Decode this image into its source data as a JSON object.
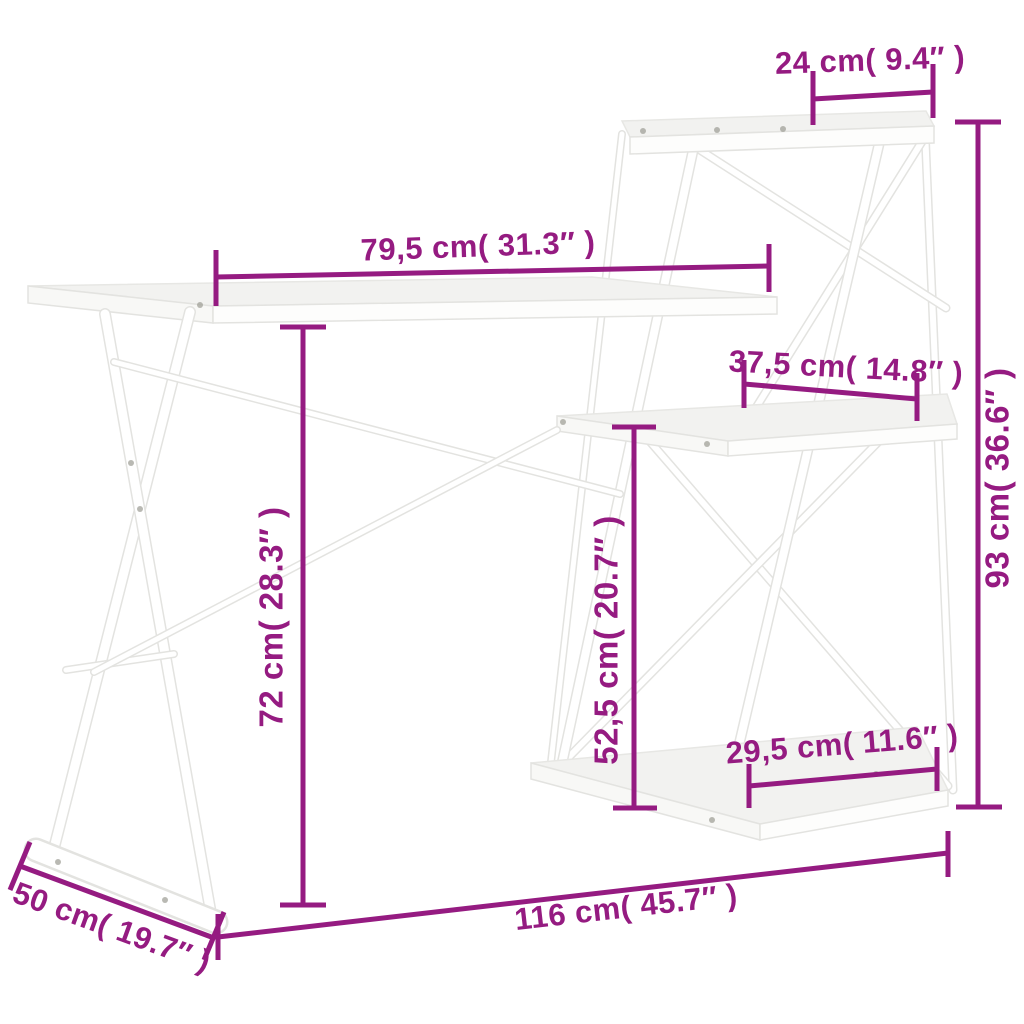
{
  "image_type": "product-dimension-diagram",
  "product": {
    "name": "desk with shelves",
    "furniture_color": "white"
  },
  "colors": {
    "accent": "#951b81",
    "background": "#ffffff",
    "furniture": "#ffffff",
    "outline": "#e3e3e0"
  },
  "dims": {
    "top_shelf_depth": {
      "label": "24 cm( 9.4″ )"
    },
    "desktop_length": {
      "label": "79,5 cm( 31.3″ )"
    },
    "middle_shelf_depth": {
      "label": "37,5 cm( 14.8″ )"
    },
    "bottom_shelf_depth": {
      "label": "29,5 cm( 11.6″ )"
    },
    "total_height": {
      "label": "93 cm( 36.6″ )"
    },
    "desktop_height": {
      "label": "72 cm( 28.3″ )"
    },
    "middle_shelf_height": {
      "label": "52,5 cm( 20.7″ )"
    },
    "total_width": {
      "label": "116 cm( 45.7″ )"
    },
    "total_depth": {
      "label": "50 cm( 19.7″ )"
    }
  }
}
